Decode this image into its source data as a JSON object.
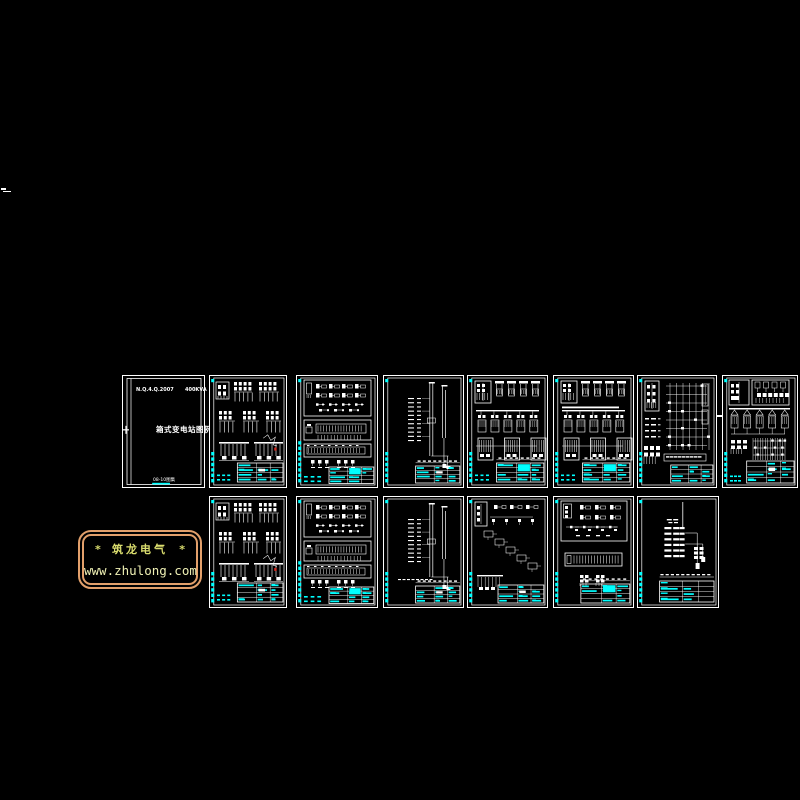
{
  "canvas": {
    "width": 800,
    "height": 800,
    "background": "#000000"
  },
  "colors": {
    "line": "#FFFFFF",
    "accent": "#00FFFF",
    "red_mark": "#D42A1E",
    "logo_border": "#E3A06B",
    "logo_text": "#DADD6E",
    "logo_url_text": "#EFF0B4"
  },
  "logo": {
    "star_left": "*",
    "title": "筑龙电气",
    "star_right": "*",
    "url": "www.zhulong.com"
  },
  "cover": {
    "code_left": "N.Q.4.Q.2007",
    "code_right": "400KVA",
    "title": "箱式变电站图例",
    "footer": "08-10图集"
  },
  "sheets": [
    {
      "id": "drawing-sheet-01",
      "name": "cover-page",
      "variant": "cover",
      "x": 122,
      "y": 375,
      "w": 83,
      "h": 113,
      "red_dot": false,
      "ticks": 0
    },
    {
      "id": "drawing-sheet-02",
      "name": "schematic-page",
      "variant": "panels",
      "x": 209,
      "y": 375,
      "w": 78,
      "h": 113,
      "red_dot": true,
      "ticks": 6
    },
    {
      "id": "drawing-sheet-03",
      "name": "schematic-page",
      "variant": "symbols",
      "x": 296,
      "y": 375,
      "w": 82,
      "h": 113,
      "red_dot": false,
      "ticks": 8
    },
    {
      "id": "drawing-sheet-04",
      "name": "riser-diagram",
      "variant": "riser",
      "x": 383,
      "y": 375,
      "w": 81,
      "h": 113,
      "red_dot": false,
      "ticks": 6
    },
    {
      "id": "drawing-sheet-05",
      "name": "switchgear-page",
      "variant": "bays",
      "x": 467,
      "y": 375,
      "w": 81,
      "h": 113,
      "red_dot": false,
      "ticks": 6
    },
    {
      "id": "drawing-sheet-06",
      "name": "switchgear-page",
      "variant": "bays2",
      "x": 553,
      "y": 375,
      "w": 81,
      "h": 113,
      "red_dot": false,
      "ticks": 6
    },
    {
      "id": "drawing-sheet-07",
      "name": "wiring-diagram",
      "variant": "wiring",
      "x": 637,
      "y": 375,
      "w": 80,
      "h": 113,
      "red_dot": false,
      "ticks": 6
    },
    {
      "id": "drawing-sheet-08",
      "name": "schematic-page",
      "variant": "dense",
      "x": 722,
      "y": 375,
      "w": 76,
      "h": 113,
      "red_dot": false,
      "ticks": 6
    },
    {
      "id": "drawing-sheet-09",
      "name": "schematic-page",
      "variant": "panels",
      "x": 209,
      "y": 496,
      "w": 78,
      "h": 112,
      "red_dot": true,
      "ticks": 6
    },
    {
      "id": "drawing-sheet-10",
      "name": "schematic-page",
      "variant": "symbols",
      "x": 296,
      "y": 496,
      "w": 82,
      "h": 112,
      "red_dot": false,
      "ticks": 8
    },
    {
      "id": "drawing-sheet-11",
      "name": "riser-diagram",
      "variant": "riser2",
      "x": 383,
      "y": 496,
      "w": 81,
      "h": 112,
      "red_dot": false,
      "ticks": 6
    },
    {
      "id": "drawing-sheet-12",
      "name": "schematic-page",
      "variant": "cascade",
      "x": 467,
      "y": 496,
      "w": 81,
      "h": 112,
      "red_dot": false,
      "ticks": 6
    },
    {
      "id": "drawing-sheet-13",
      "name": "schematic-page",
      "variant": "symbols2",
      "x": 553,
      "y": 496,
      "w": 81,
      "h": 112,
      "red_dot": false,
      "ticks": 6
    },
    {
      "id": "drawing-sheet-14",
      "name": "riser-diagram",
      "variant": "sparse",
      "x": 637,
      "y": 496,
      "w": 82,
      "h": 112,
      "red_dot": false,
      "ticks": 6
    }
  ]
}
